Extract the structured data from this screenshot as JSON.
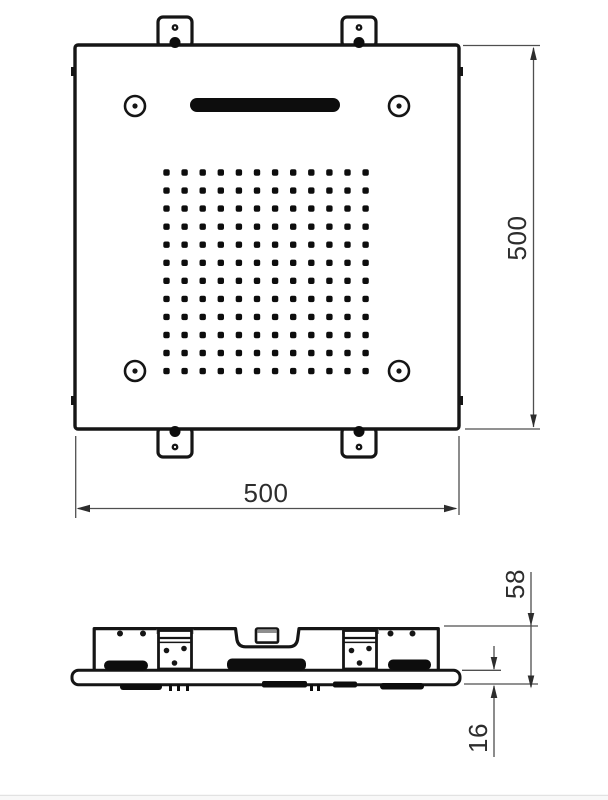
{
  "document": {
    "type": "technical line drawing",
    "subject": "Square ceiling shower head - dimensioned drawing",
    "views": [
      {
        "id": "top",
        "name": "top plan view"
      },
      {
        "id": "side",
        "name": "side profile view"
      }
    ]
  },
  "top_view": {
    "width_label": "500",
    "height_label": "500",
    "nozzle_grid": {
      "rows": 12,
      "cols": 12
    },
    "screw_holes": 4,
    "mounting_tabs": 4,
    "waterfall_slot": 1
  },
  "side_view": {
    "overall_height_label": "58",
    "flange_thickness_label": "16"
  },
  "colors": {
    "line": "#151515",
    "fill_black": "#0d0d0d",
    "dimension_line": "#4f4f4f",
    "dimension_text": "#2d2d2d",
    "bracket_shade": "#8e8e8e",
    "background": "#ffffff",
    "footer_line": "#e2e2e2"
  }
}
